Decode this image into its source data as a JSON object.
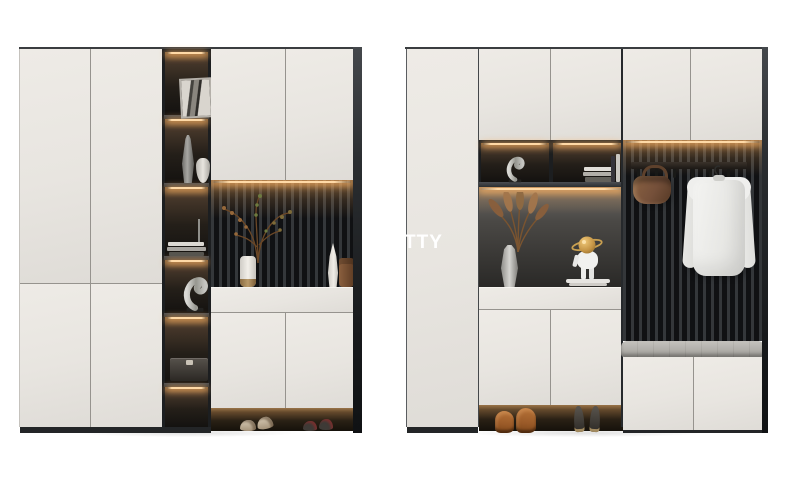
{
  "watermark": {
    "text": "TTY"
  },
  "colors": {
    "bg": "#ffffff",
    "door": "#e8e5e0",
    "door-light": "#eeebe6",
    "door-dark": "#dfdcd7",
    "seam": "#96938e",
    "frame": "#3a3d40",
    "panel": "#1c1e20",
    "slat-light": "#34373a",
    "slat-dark": "#101113",
    "led": "#ffd9a6",
    "glow": "#c98e54",
    "base": "#232527",
    "cushion": "#b5b3ae",
    "leather": "#75503a",
    "boot": "#9a5a28",
    "metal": "#bfbfbb",
    "shirt": "#efefed"
  },
  "scene": {
    "description": "Product render of two modern entryway storage cabinet units on white background",
    "left_unit": {
      "name": "wardrobe with open display shelf column, slatted niche and shoe cabinet",
      "decor_items": [
        "abstract-art-frame",
        "tall-gray-vase",
        "small-white-vase",
        "book-stack",
        "swan-sculpture",
        "storage-box",
        "branch-vase",
        "teardrop-ornament",
        "leather-clutch",
        "beige-slippers",
        "dark-flats"
      ]
    },
    "right_unit": {
      "name": "hallway unit with coat hook panel, bench seat and shoe storage",
      "decor_items": [
        "swan-sculpture",
        "book-stack",
        "pampas-grass-vase",
        "astronaut-figurine",
        "hook-rail",
        "leather-handbag",
        "white-shirt-on-hanger",
        "bench-cushion",
        "brown-ankle-boots",
        "black-heels"
      ]
    }
  }
}
